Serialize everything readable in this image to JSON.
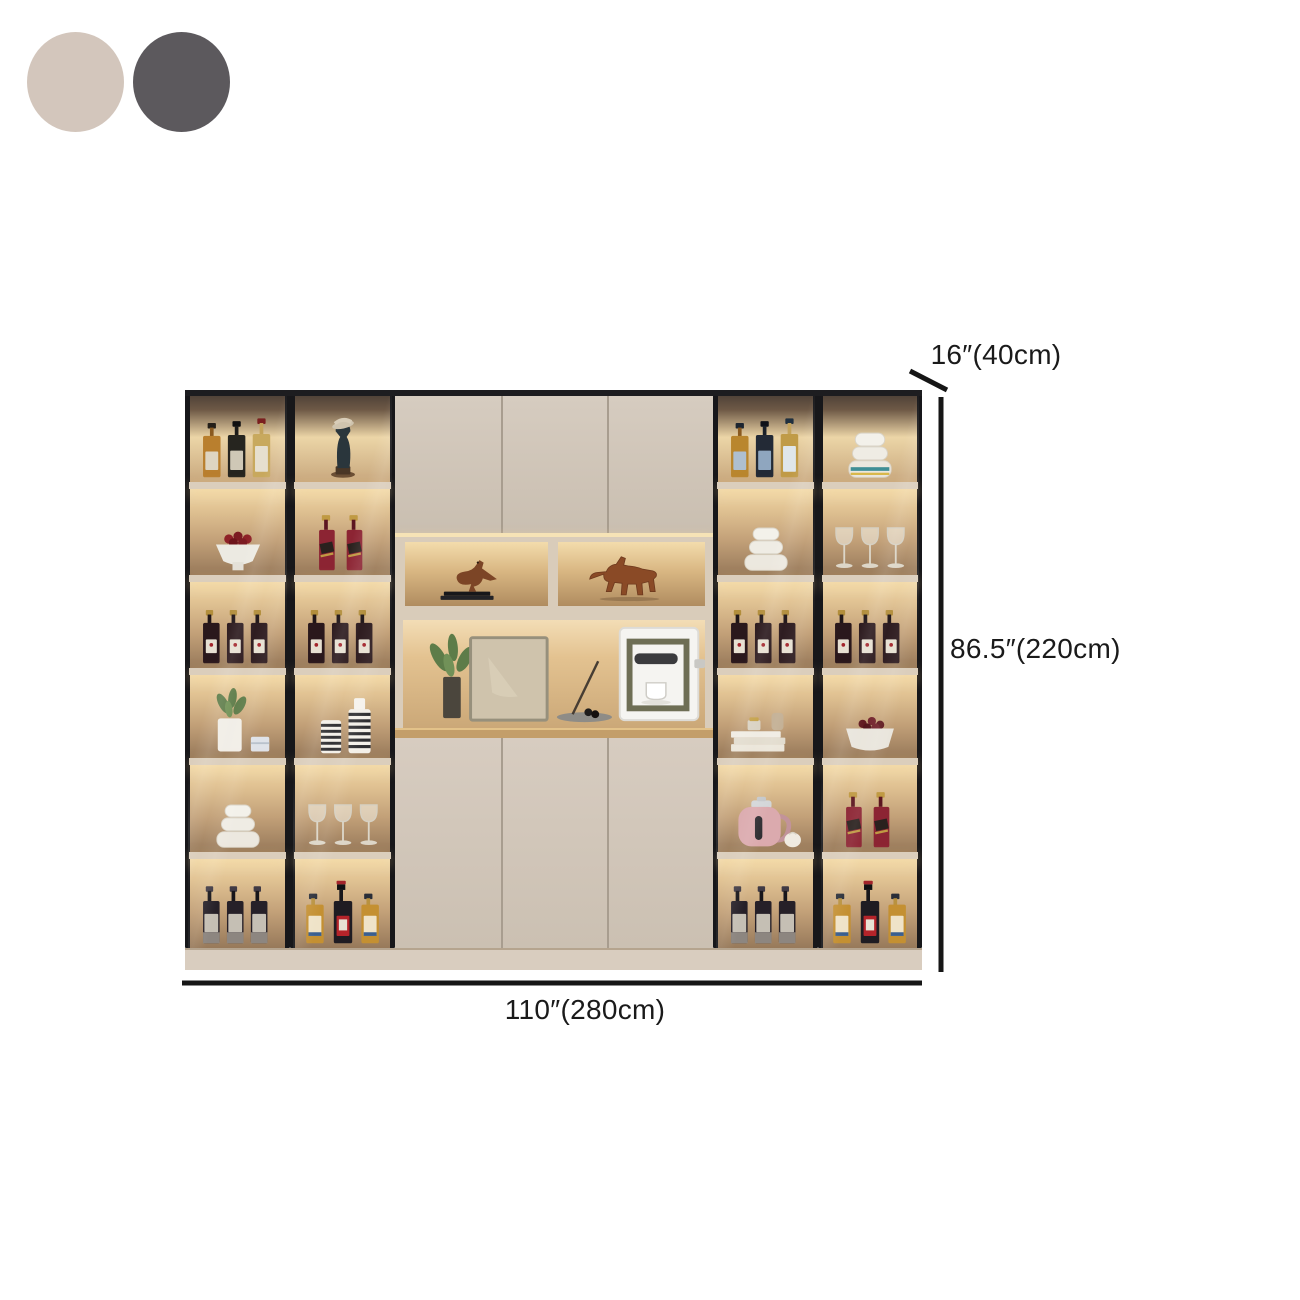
{
  "swatches": [
    {
      "name": "beige",
      "color": "#d3c6bc"
    },
    {
      "name": "dark-gray",
      "color": "#5c595d"
    }
  ],
  "dimensions": {
    "depth": "16″(40cm)",
    "height": "86.5″(220cm)",
    "width": "110″(280cm)"
  },
  "colors": {
    "frame": "#17171a",
    "door": "#cfc4b6",
    "glow": "#f3dcae",
    "wood_counter": "#c39e6a",
    "plinth": "#d9cdbf",
    "dimension_line": "#161616"
  },
  "cabinet": {
    "left_columns": [
      {
        "rows": [
          "liquor-bottles",
          "fruit-bowl",
          "wine-bottles",
          "plant-pot",
          "bowl-stack",
          "dark-bottles"
        ]
      },
      {
        "rows": [
          "figurine",
          "red-label-bottles",
          "wine-bottles",
          "striped-vases",
          "wine-glasses",
          "mixed-bottles"
        ]
      }
    ],
    "right_columns": [
      {
        "rows": [
          "liquor-bottles-blue",
          "bowl-stack",
          "wine-bottles",
          "books-vases",
          "kettle",
          "dark-bottles"
        ]
      },
      {
        "rows": [
          "teal-bowl-stack",
          "wine-glasses",
          "wine-bottles",
          "cherry-bowl",
          "red-label-bottles",
          "mixed-bottles"
        ]
      }
    ],
    "middle": {
      "top_door_count": 3,
      "niche_items": [
        "bird-figurine",
        "horse-figurine"
      ],
      "display_items": [
        "plant",
        "picture-frame",
        "incense-tray",
        "coffee-machine"
      ],
      "bottom_door_count": 3
    }
  }
}
